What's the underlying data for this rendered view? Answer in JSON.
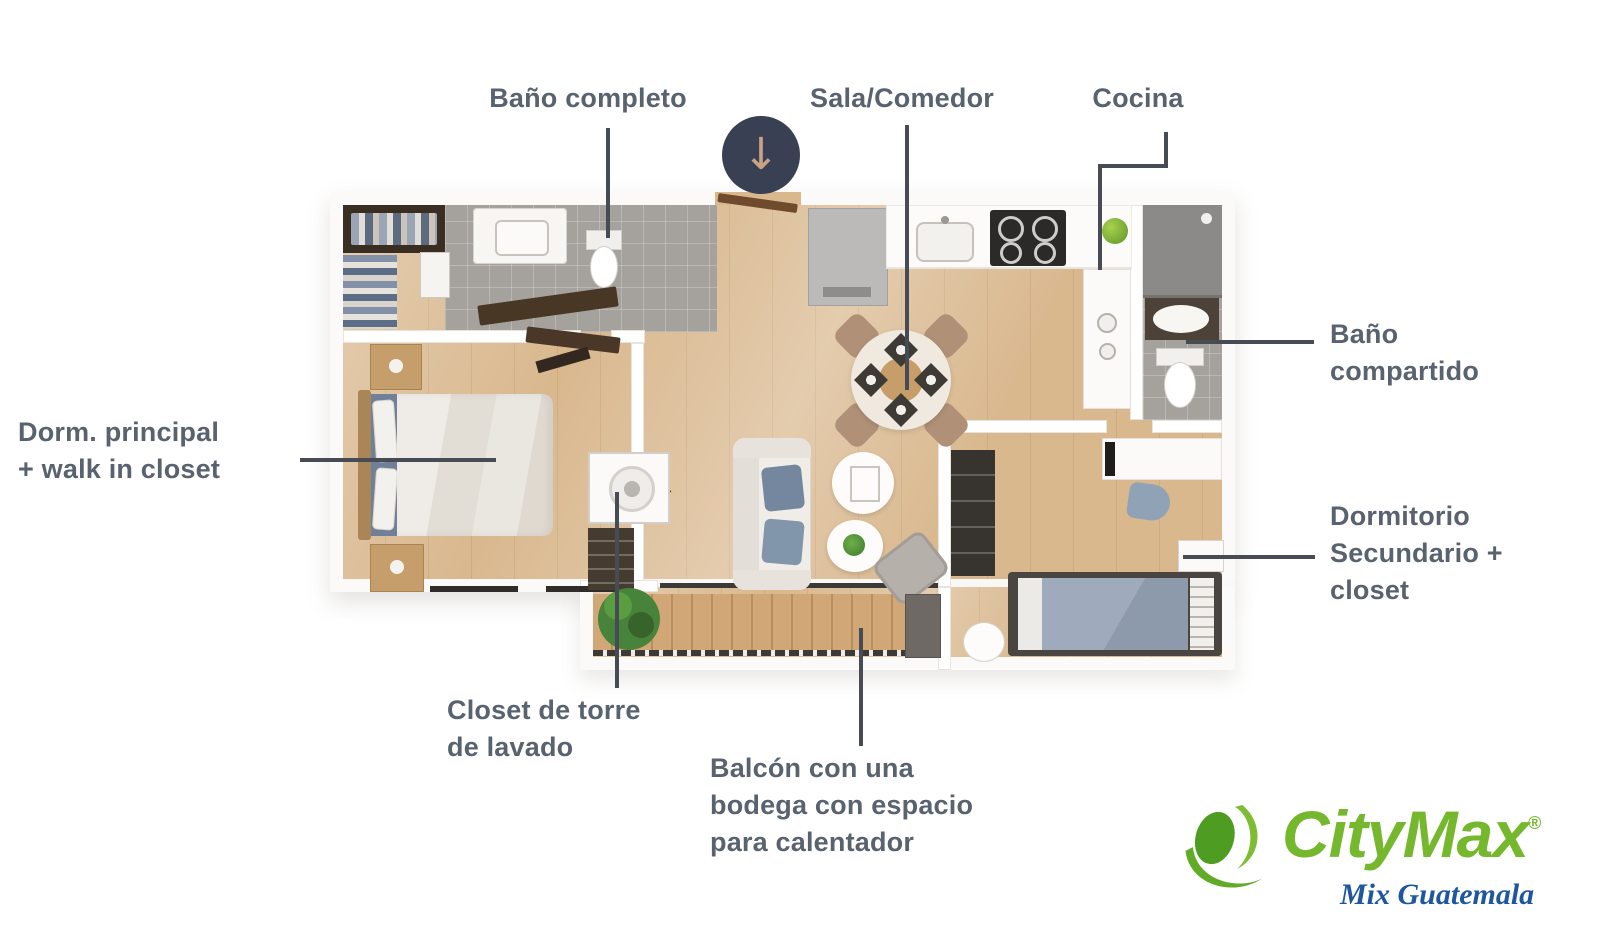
{
  "labels": {
    "bano_completo": "Baño completo",
    "sala_comedor": "Sala/Comedor",
    "cocina": "Cocina",
    "bano_compartido": "Baño\ncompartido",
    "dormitorio_secundario": "Dormitorio\nSecundario +\ncloset",
    "dorm_principal": "Dorm. principal\n+ walk in closet",
    "closet_lavado": "Closet de torre\nde lavado",
    "balcon": "Balcón con una\nbodega con espacio\npara calentador"
  },
  "icons": {
    "entrance_arrow": "↓"
  },
  "logo": {
    "brand": "CityMax",
    "registered": "®",
    "tagline": "Mix Guatemala"
  },
  "colors": {
    "label_text": "#59626f",
    "leader_line": "#464b54",
    "entrance_circle": "#3a4053",
    "entrance_arrow": "#c9a183",
    "wood_floor": "#d9b88e",
    "tile_floor": "#a5a29e",
    "brand_green": "#76b82d",
    "tagline_blue": "#1e56a0"
  }
}
